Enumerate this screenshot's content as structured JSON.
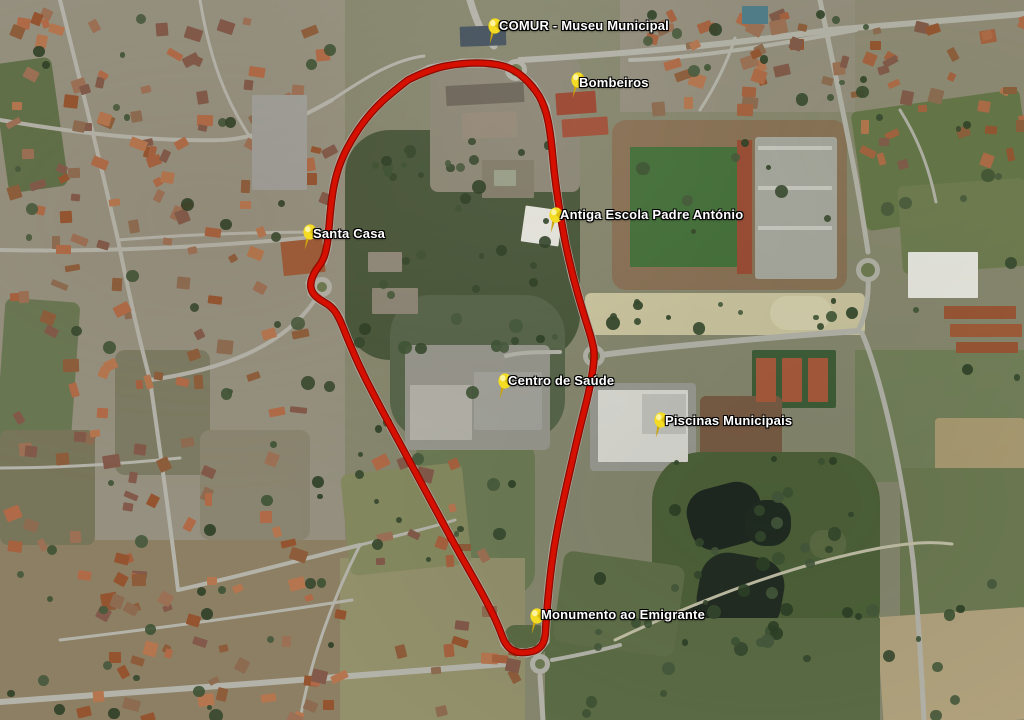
{
  "map": {
    "view": "aerial-satellite",
    "route": {
      "color": "#d61000",
      "outline_color": "#8f0a00",
      "width": 5,
      "points": [
        [
          408,
          80
        ],
        [
          430,
          69
        ],
        [
          462,
          63
        ],
        [
          492,
          63
        ],
        [
          514,
          69
        ],
        [
          533,
          86
        ],
        [
          545,
          106
        ],
        [
          551,
          136
        ],
        [
          554,
          172
        ],
        [
          559,
          207
        ],
        [
          565,
          242
        ],
        [
          573,
          277
        ],
        [
          583,
          312
        ],
        [
          592,
          340
        ],
        [
          595,
          356
        ],
        [
          590,
          388
        ],
        [
          580,
          427
        ],
        [
          571,
          466
        ],
        [
          562,
          506
        ],
        [
          554,
          546
        ],
        [
          549,
          586
        ],
        [
          546,
          622
        ],
        [
          545,
          641
        ],
        [
          538,
          650
        ],
        [
          526,
          653
        ],
        [
          514,
          652
        ],
        [
          505,
          644
        ],
        [
          500,
          630
        ],
        [
          492,
          612
        ],
        [
          477,
          584
        ],
        [
          458,
          551
        ],
        [
          438,
          514
        ],
        [
          418,
          477
        ],
        [
          398,
          440
        ],
        [
          378,
          403
        ],
        [
          361,
          370
        ],
        [
          348,
          340
        ],
        [
          339,
          317
        ],
        [
          331,
          306
        ],
        [
          320,
          300
        ],
        [
          312,
          293
        ],
        [
          310,
          283
        ],
        [
          315,
          271
        ],
        [
          323,
          261
        ],
        [
          327,
          247
        ],
        [
          329,
          228
        ],
        [
          331,
          203
        ],
        [
          335,
          179
        ],
        [
          342,
          158
        ],
        [
          352,
          139
        ],
        [
          364,
          121
        ],
        [
          379,
          104
        ],
        [
          394,
          91
        ],
        [
          408,
          80
        ]
      ]
    },
    "pins": [
      {
        "label": "COMUR - Museu Municipal",
        "x": 490,
        "y": 44,
        "label_x": 499,
        "label_y": 18
      },
      {
        "label": "Bombeiros",
        "x": 573,
        "y": 98,
        "label_x": 579,
        "label_y": 75
      },
      {
        "label": "Antiga Escola Padre António",
        "x": 551,
        "y": 233,
        "label_x": 560,
        "label_y": 207
      },
      {
        "label": "Santa Casa",
        "x": 305,
        "y": 250,
        "label_x": 313,
        "label_y": 226
      },
      {
        "label": "Centro de Saúde",
        "x": 500,
        "y": 399,
        "label_x": 508,
        "label_y": 373
      },
      {
        "label": "Piscinas Municipais",
        "x": 656,
        "y": 438,
        "label_x": 665,
        "label_y": 413
      },
      {
        "label": "Monumento ao Emigrante",
        "x": 532,
        "y": 634,
        "label_x": 541,
        "label_y": 607
      }
    ]
  }
}
